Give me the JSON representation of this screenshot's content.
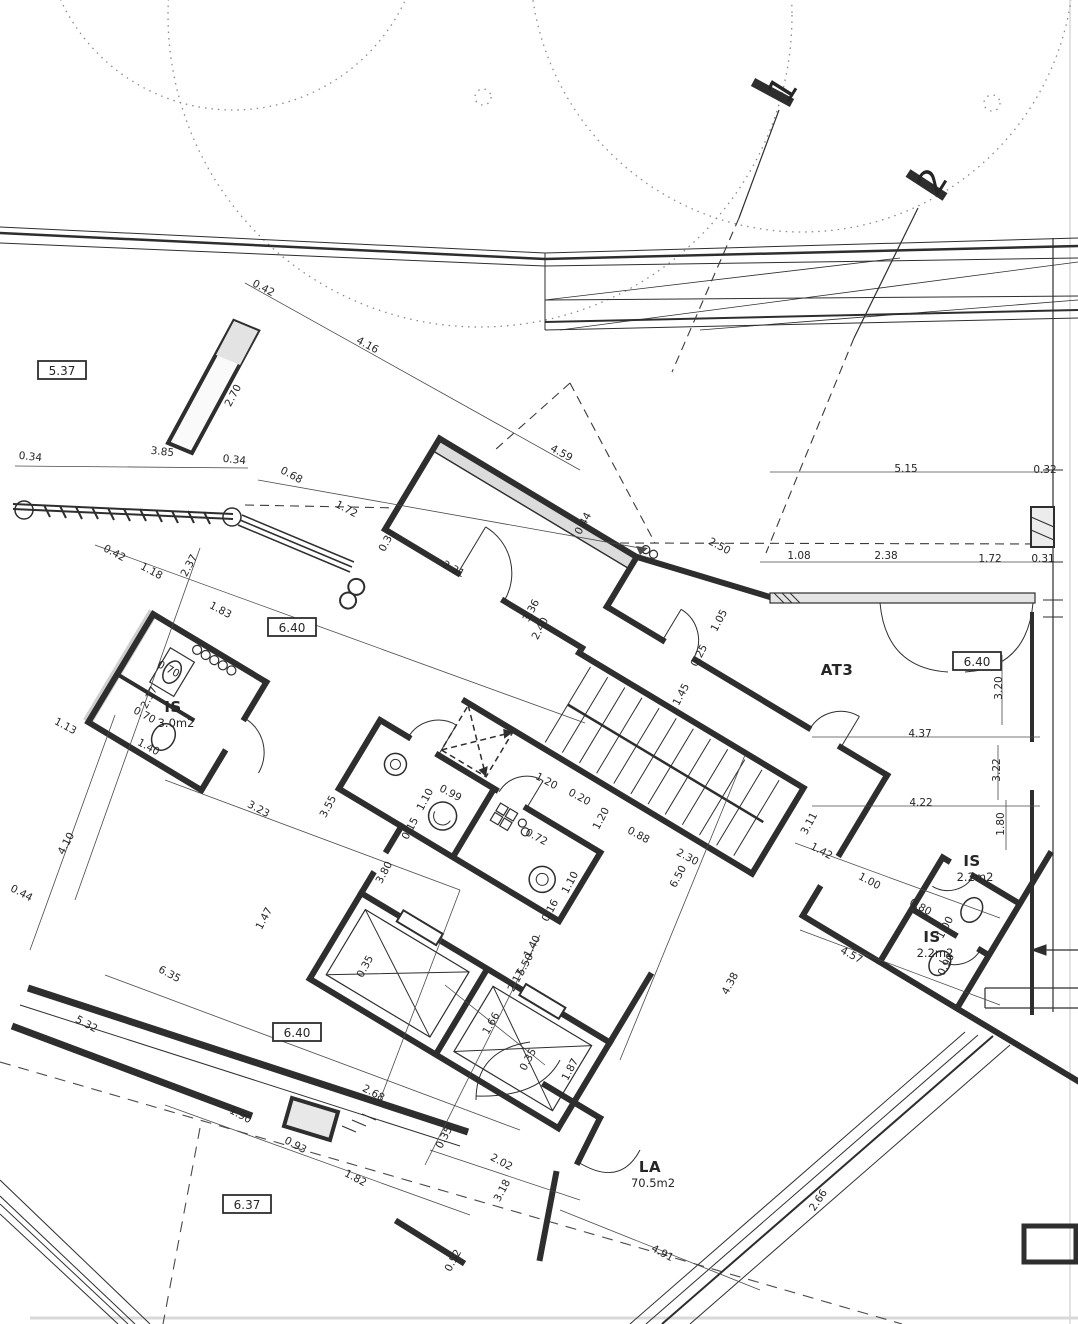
{
  "section_markers": [
    {
      "label": "1",
      "x": 793,
      "y": 96,
      "rot": -58
    },
    {
      "label": "2",
      "x": 943,
      "y": 188,
      "rot": -58
    }
  ],
  "level_markers": [
    {
      "label": "5.37",
      "x": 62,
      "y": 371
    },
    {
      "label": "6.40",
      "x": 292,
      "y": 628
    },
    {
      "label": "6.40",
      "x": 977,
      "y": 662
    },
    {
      "label": "6.40",
      "x": 297,
      "y": 1033
    },
    {
      "label": "6.37",
      "x": 247,
      "y": 1205
    }
  ],
  "rooms": [
    {
      "name": "IS",
      "area": "3.0m2",
      "x": 173,
      "y": 712
    },
    {
      "name": "AT3",
      "area": "",
      "x": 837,
      "y": 675
    },
    {
      "name": "IS",
      "area": "2.2m2",
      "x": 972,
      "y": 866
    },
    {
      "name": "IS",
      "area": "2.2m2",
      "x": 932,
      "y": 942
    },
    {
      "name": "LA",
      "area": "70.5m2",
      "x": 650,
      "y": 1172
    }
  ],
  "dimensions": [
    {
      "t": "0.42",
      "x": 262,
      "y": 291,
      "r": 28
    },
    {
      "t": "4.16",
      "x": 366,
      "y": 348,
      "r": 28
    },
    {
      "t": "2.70",
      "x": 236,
      "y": 397,
      "r": -62
    },
    {
      "t": "0.34",
      "x": 30,
      "y": 460,
      "r": 6
    },
    {
      "t": "3.85",
      "x": 162,
      "y": 455,
      "r": 6
    },
    {
      "t": "0.34",
      "x": 234,
      "y": 463,
      "r": 6
    },
    {
      "t": "0.68",
      "x": 290,
      "y": 478,
      "r": 28
    },
    {
      "t": "1.72",
      "x": 345,
      "y": 512,
      "r": 28
    },
    {
      "t": "4.59",
      "x": 560,
      "y": 456,
      "r": 28
    },
    {
      "t": "0.35",
      "x": 390,
      "y": 542,
      "r": -62
    },
    {
      "t": "2.31",
      "x": 452,
      "y": 572,
      "r": 28
    },
    {
      "t": "0.44",
      "x": 586,
      "y": 525,
      "r": -62
    },
    {
      "t": "2.50",
      "x": 718,
      "y": 549,
      "r": 28
    },
    {
      "t": "1.08",
      "x": 799,
      "y": 559,
      "r": 0
    },
    {
      "t": "2.38",
      "x": 886,
      "y": 559,
      "r": 0
    },
    {
      "t": "1.72",
      "x": 990,
      "y": 562,
      "r": 0
    },
    {
      "t": "0.31",
      "x": 1043,
      "y": 562,
      "r": 0
    },
    {
      "t": "5.15",
      "x": 906,
      "y": 472,
      "r": 0
    },
    {
      "t": "0.32",
      "x": 1045,
      "y": 473,
      "r": 0
    },
    {
      "t": "0.42",
      "x": 113,
      "y": 556,
      "r": 28
    },
    {
      "t": "1.18",
      "x": 150,
      "y": 574,
      "r": 28
    },
    {
      "t": "2.37",
      "x": 192,
      "y": 567,
      "r": -62
    },
    {
      "t": "1.83",
      "x": 219,
      "y": 613,
      "r": 28
    },
    {
      "t": "2.17",
      "x": 152,
      "y": 699,
      "r": -62
    },
    {
      "t": "0.70",
      "x": 167,
      "y": 672,
      "r": 28
    },
    {
      "t": "0.70",
      "x": 143,
      "y": 718,
      "r": 28
    },
    {
      "t": "1.40",
      "x": 147,
      "y": 750,
      "r": 28
    },
    {
      "t": "1.13",
      "x": 64,
      "y": 729,
      "r": 28
    },
    {
      "t": "3.36",
      "x": 534,
      "y": 612,
      "r": -62
    },
    {
      "t": "2.40",
      "x": 543,
      "y": 630,
      "r": -62
    },
    {
      "t": "1.05",
      "x": 722,
      "y": 622,
      "r": -62
    },
    {
      "t": "0.25",
      "x": 702,
      "y": 657,
      "r": -62
    },
    {
      "t": "1.45",
      "x": 684,
      "y": 696,
      "r": -62
    },
    {
      "t": "1.20",
      "x": 545,
      "y": 784,
      "r": 28
    },
    {
      "t": "0.20",
      "x": 578,
      "y": 800,
      "r": 28
    },
    {
      "t": "1.20",
      "x": 604,
      "y": 820,
      "r": -62
    },
    {
      "t": "1.10",
      "x": 428,
      "y": 801,
      "r": -62
    },
    {
      "t": "0.99",
      "x": 449,
      "y": 796,
      "r": 28
    },
    {
      "t": "0.15",
      "x": 413,
      "y": 830,
      "r": -62
    },
    {
      "t": "3.80",
      "x": 387,
      "y": 874,
      "r": -62
    },
    {
      "t": "0.72",
      "x": 535,
      "y": 840,
      "r": 28
    },
    {
      "t": "1.10",
      "x": 573,
      "y": 884,
      "r": -62
    },
    {
      "t": "0.16",
      "x": 553,
      "y": 912,
      "r": -62
    },
    {
      "t": "0.88",
      "x": 637,
      "y": 838,
      "r": 28
    },
    {
      "t": "2.30",
      "x": 686,
      "y": 860,
      "r": 28
    },
    {
      "t": "6.50",
      "x": 681,
      "y": 878,
      "r": -62
    },
    {
      "t": "1.66",
      "x": 494,
      "y": 1025,
      "r": -60
    },
    {
      "t": "1.40",
      "x": 535,
      "y": 948,
      "r": -62
    },
    {
      "t": "5.50",
      "x": 528,
      "y": 966,
      "r": -62
    },
    {
      "t": "2.17",
      "x": 519,
      "y": 982,
      "r": -62
    },
    {
      "t": "0.35",
      "x": 368,
      "y": 968,
      "r": -62
    },
    {
      "t": "0.35",
      "x": 531,
      "y": 1061,
      "r": -62
    },
    {
      "t": "1.87",
      "x": 573,
      "y": 1071,
      "r": -62
    },
    {
      "t": "0.35",
      "x": 447,
      "y": 1139,
      "r": -62
    },
    {
      "t": "2.68",
      "x": 372,
      "y": 1096,
      "r": 28
    },
    {
      "t": "2.02",
      "x": 500,
      "y": 1165,
      "r": 28
    },
    {
      "t": "3.18",
      "x": 505,
      "y": 1192,
      "r": -62
    },
    {
      "t": "0.52",
      "x": 456,
      "y": 1262,
      "r": -62
    },
    {
      "t": "4.91",
      "x": 661,
      "y": 1256,
      "r": 28
    },
    {
      "t": "2.66",
      "x": 821,
      "y": 1202,
      "r": -56
    },
    {
      "t": "4.38",
      "x": 733,
      "y": 985,
      "r": -62
    },
    {
      "t": "3.23",
      "x": 257,
      "y": 812,
      "r": 28
    },
    {
      "t": "3.55",
      "x": 331,
      "y": 808,
      "r": -62
    },
    {
      "t": "4.10",
      "x": 69,
      "y": 845,
      "r": -62
    },
    {
      "t": "1.47",
      "x": 267,
      "y": 920,
      "r": -62
    },
    {
      "t": "0.44",
      "x": 20,
      "y": 896,
      "r": 28
    },
    {
      "t": "6.35",
      "x": 168,
      "y": 977,
      "r": 28
    },
    {
      "t": "5.32",
      "x": 85,
      "y": 1027,
      "r": 28
    },
    {
      "t": "1.90",
      "x": 239,
      "y": 1118,
      "r": 28
    },
    {
      "t": "0.93",
      "x": 294,
      "y": 1148,
      "r": 28
    },
    {
      "t": "1.82",
      "x": 354,
      "y": 1181,
      "r": 28
    },
    {
      "t": "4.37",
      "x": 920,
      "y": 737,
      "r": 0
    },
    {
      "t": "3.20",
      "x": 1002,
      "y": 688,
      "r": -90
    },
    {
      "t": "3.22",
      "x": 1000,
      "y": 770,
      "r": -90
    },
    {
      "t": "4.22",
      "x": 921,
      "y": 806,
      "r": 0
    },
    {
      "t": "1.80",
      "x": 1004,
      "y": 824,
      "r": -90
    },
    {
      "t": "3.11",
      "x": 812,
      "y": 825,
      "r": -62
    },
    {
      "t": "1.42",
      "x": 820,
      "y": 854,
      "r": 28
    },
    {
      "t": "1.00",
      "x": 868,
      "y": 884,
      "r": 28
    },
    {
      "t": "0.80",
      "x": 919,
      "y": 910,
      "r": 28
    },
    {
      "t": "4.57",
      "x": 850,
      "y": 958,
      "r": 28
    },
    {
      "t": "1.00",
      "x": 948,
      "y": 929,
      "r": -62
    },
    {
      "t": "0.90",
      "x": 949,
      "y": 966,
      "r": -62
    }
  ]
}
